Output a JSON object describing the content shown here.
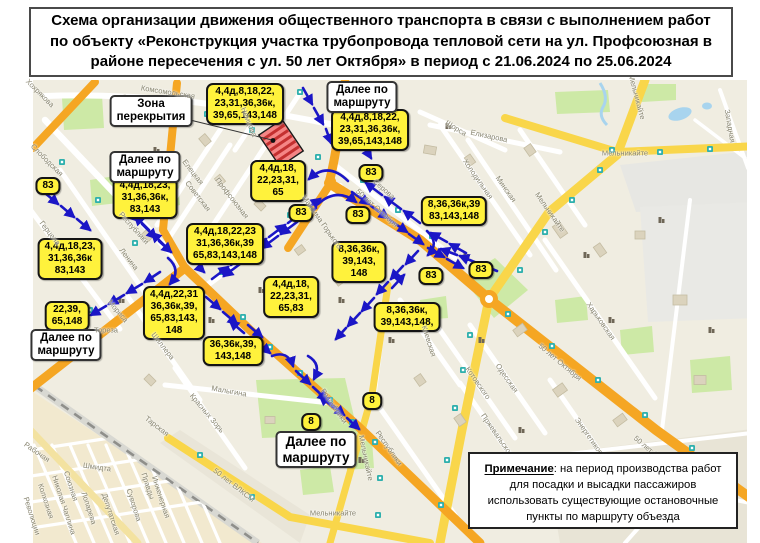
{
  "title": {
    "lines": [
      "Схема организации движения общественного транспорта в связи с выполнением работ",
      "по объекту «Реконструкция участка трубопровода тепловой сети на ул. Профсоюзная в",
      "районе пересечения с ул. 50 лет Октября» в период с 21.06.2024 по 25.06.2024"
    ]
  },
  "note": {
    "heading": "Примечание",
    "text": ": на период производства работ для посадки и высадки пассажиров использовать существующие остановочные пункты по маршруту объезда"
  },
  "map": {
    "closure_label": {
      "lines": [
        "Зона",
        "перекрытия"
      ],
      "x": 151,
      "y": 95
    },
    "detour_labels": [
      {
        "lines": [
          "Далее по",
          "маршруту"
        ],
        "x": 362,
        "y": 81,
        "big": false
      },
      {
        "lines": [
          "Далее по",
          "маршруту"
        ],
        "x": 145,
        "y": 151,
        "big": false
      },
      {
        "lines": [
          "Далее по",
          "маршруту"
        ],
        "x": 66,
        "y": 329,
        "big": false
      },
      {
        "lines": [
          "Далее по",
          "маршруту"
        ],
        "x": 316,
        "y": 431,
        "big": true
      }
    ],
    "route_labels": [
      {
        "lines": [
          "4,4д,8,18,22,",
          "23,31,36,36к,",
          "39,65,143,148"
        ],
        "x": 245,
        "y": 83
      },
      {
        "lines": [
          "4,4д,8,18,22,",
          "23,31,36,36к,",
          "39,65,143,148"
        ],
        "x": 370,
        "y": 109
      },
      {
        "lines": [
          "4,4д,18,23,",
          "31,36,36к,",
          "83,143"
        ],
        "x": 145,
        "y": 177
      },
      {
        "lines": [
          "4,4д,18,",
          "22,23,31,",
          "65"
        ],
        "x": 278,
        "y": 160
      },
      {
        "lines": [
          "83"
        ],
        "x": 371,
        "y": 164
      },
      {
        "lines": [
          "83"
        ],
        "x": 48,
        "y": 177
      },
      {
        "lines": [
          "4,4д,18,23,",
          "31,36,36к",
          "83,143"
        ],
        "x": 70,
        "y": 238
      },
      {
        "lines": [
          "4,4д,18,22,23",
          "31,36,36к,39",
          "65,83,143,148"
        ],
        "x": 225,
        "y": 223
      },
      {
        "lines": [
          "8,36,36к,39",
          "83,143,148"
        ],
        "x": 454,
        "y": 196
      },
      {
        "lines": [
          "83"
        ],
        "x": 301,
        "y": 204
      },
      {
        "lines": [
          "83"
        ],
        "x": 358,
        "y": 206
      },
      {
        "lines": [
          "8,36,36к,",
          "39,143,",
          "148"
        ],
        "x": 359,
        "y": 241
      },
      {
        "lines": [
          "4,4д,18,",
          "22,23,31,",
          "65,83"
        ],
        "x": 291,
        "y": 276
      },
      {
        "lines": [
          "4,4д,22,31",
          "36,36к,39,",
          "65,83,143,",
          "148"
        ],
        "x": 174,
        "y": 286
      },
      {
        "lines": [
          "22,39,",
          "65,148"
        ],
        "x": 67,
        "y": 301
      },
      {
        "lines": [
          "8,36,36к,",
          "39,143,148,"
        ],
        "x": 407,
        "y": 302
      },
      {
        "lines": [
          "83"
        ],
        "x": 431,
        "y": 267
      },
      {
        "lines": [
          "83"
        ],
        "x": 481,
        "y": 261
      },
      {
        "lines": [
          "36,36к,39,",
          "143,148"
        ],
        "x": 233,
        "y": 336
      },
      {
        "lines": [
          "8"
        ],
        "x": 372,
        "y": 392
      },
      {
        "lines": [
          "8"
        ],
        "x": 311,
        "y": 413
      }
    ],
    "street_labels": [
      {
        "t": "Комсомольская",
        "x": 168,
        "y": 92,
        "r": 9
      },
      {
        "t": "Хохрякова",
        "x": 40,
        "y": 93,
        "r": 45
      },
      {
        "t": "Слободская",
        "x": 47,
        "y": 160,
        "r": 45
      },
      {
        "t": "Немцова",
        "x": 249,
        "y": 122,
        "r": 68
      },
      {
        "t": "Елецкая",
        "x": 193,
        "y": 172,
        "r": 52
      },
      {
        "t": "Советская",
        "x": 198,
        "y": 196,
        "r": 52
      },
      {
        "t": "Профсоюзная",
        "x": 232,
        "y": 198,
        "r": 52
      },
      {
        "t": "Герцена",
        "x": 50,
        "y": 233,
        "r": 52
      },
      {
        "t": "Ленина",
        "x": 129,
        "y": 259,
        "r": 52
      },
      {
        "t": "Республики",
        "x": 134,
        "y": 228,
        "r": 48
      },
      {
        "t": "Мориса",
        "x": 118,
        "y": 311,
        "r": 50
      },
      {
        "t": "Тореза",
        "x": 106,
        "y": 330,
        "r": 0
      },
      {
        "t": "Максима Горького",
        "x": 322,
        "y": 222,
        "r": 55
      },
      {
        "t": "Серова",
        "x": 384,
        "y": 189,
        "r": 42
      },
      {
        "t": "50 лет Октября",
        "x": 377,
        "y": 208,
        "r": 42
      },
      {
        "t": "50 лет Октября",
        "x": 560,
        "y": 362,
        "r": 40
      },
      {
        "t": "50 лет Окт",
        "x": 649,
        "y": 449,
        "r": 40
      },
      {
        "t": "Щорса",
        "x": 456,
        "y": 128,
        "r": 32
      },
      {
        "t": "Елизарова",
        "x": 489,
        "y": 136,
        "r": 12
      },
      {
        "t": "Холодильная",
        "x": 478,
        "y": 179,
        "r": 55
      },
      {
        "t": "Минская",
        "x": 506,
        "y": 189,
        "r": 55
      },
      {
        "t": "Мельникайте",
        "x": 550,
        "y": 212,
        "r": 55
      },
      {
        "t": "Мельникайте",
        "x": 625,
        "y": 153,
        "r": 0
      },
      {
        "t": "Мельникайте",
        "x": 637,
        "y": 97,
        "r": 75
      },
      {
        "t": "Западная",
        "x": 730,
        "y": 126,
        "r": 80
      },
      {
        "t": "Харьковская",
        "x": 601,
        "y": 321,
        "r": 55
      },
      {
        "t": "Котовского",
        "x": 478,
        "y": 383,
        "r": 55
      },
      {
        "t": "Одесская",
        "x": 507,
        "y": 378,
        "r": 55
      },
      {
        "t": "Пржевальского",
        "x": 498,
        "y": 436,
        "r": 55
      },
      {
        "t": "Энергетиков",
        "x": 589,
        "y": 436,
        "r": 55
      },
      {
        "t": "Киевская",
        "x": 429,
        "y": 341,
        "r": 72
      },
      {
        "t": "Республики",
        "x": 334,
        "y": 406,
        "r": 55
      },
      {
        "t": "Республики",
        "x": 389,
        "y": 448,
        "r": 55
      },
      {
        "t": "Мельникайте",
        "x": 366,
        "y": 458,
        "r": 78
      },
      {
        "t": "Мельникайте",
        "x": 333,
        "y": 513,
        "r": 0
      },
      {
        "t": "Малыгина",
        "x": 229,
        "y": 391,
        "r": 10
      },
      {
        "t": "Красных Зорь",
        "x": 207,
        "y": 413,
        "r": 50
      },
      {
        "t": "Шиллера",
        "x": 163,
        "y": 346,
        "r": 52
      },
      {
        "t": "Тарская",
        "x": 157,
        "y": 426,
        "r": 38
      },
      {
        "t": "Рабочая",
        "x": 37,
        "y": 452,
        "r": 35
      },
      {
        "t": "Шмидта",
        "x": 97,
        "y": 467,
        "r": 8
      },
      {
        "t": "Союзная",
        "x": 71,
        "y": 486,
        "r": 72
      },
      {
        "t": "Николая Чаплина",
        "x": 64,
        "y": 505,
        "r": 72
      },
      {
        "t": "Колхозная",
        "x": 46,
        "y": 501,
        "r": 72
      },
      {
        "t": "Революции",
        "x": 32,
        "y": 516,
        "r": 72
      },
      {
        "t": "Лопарева",
        "x": 89,
        "y": 508,
        "r": 72
      },
      {
        "t": "Депутатская",
        "x": 111,
        "y": 514,
        "r": 72
      },
      {
        "t": "Суворова",
        "x": 134,
        "y": 505,
        "r": 72
      },
      {
        "t": "Правды",
        "x": 148,
        "y": 486,
        "r": 72
      },
      {
        "t": "Инженерная",
        "x": 161,
        "y": 497,
        "r": 72
      },
      {
        "t": "50 лет ВЛКСМ",
        "x": 234,
        "y": 485,
        "r": 38
      }
    ]
  }
}
